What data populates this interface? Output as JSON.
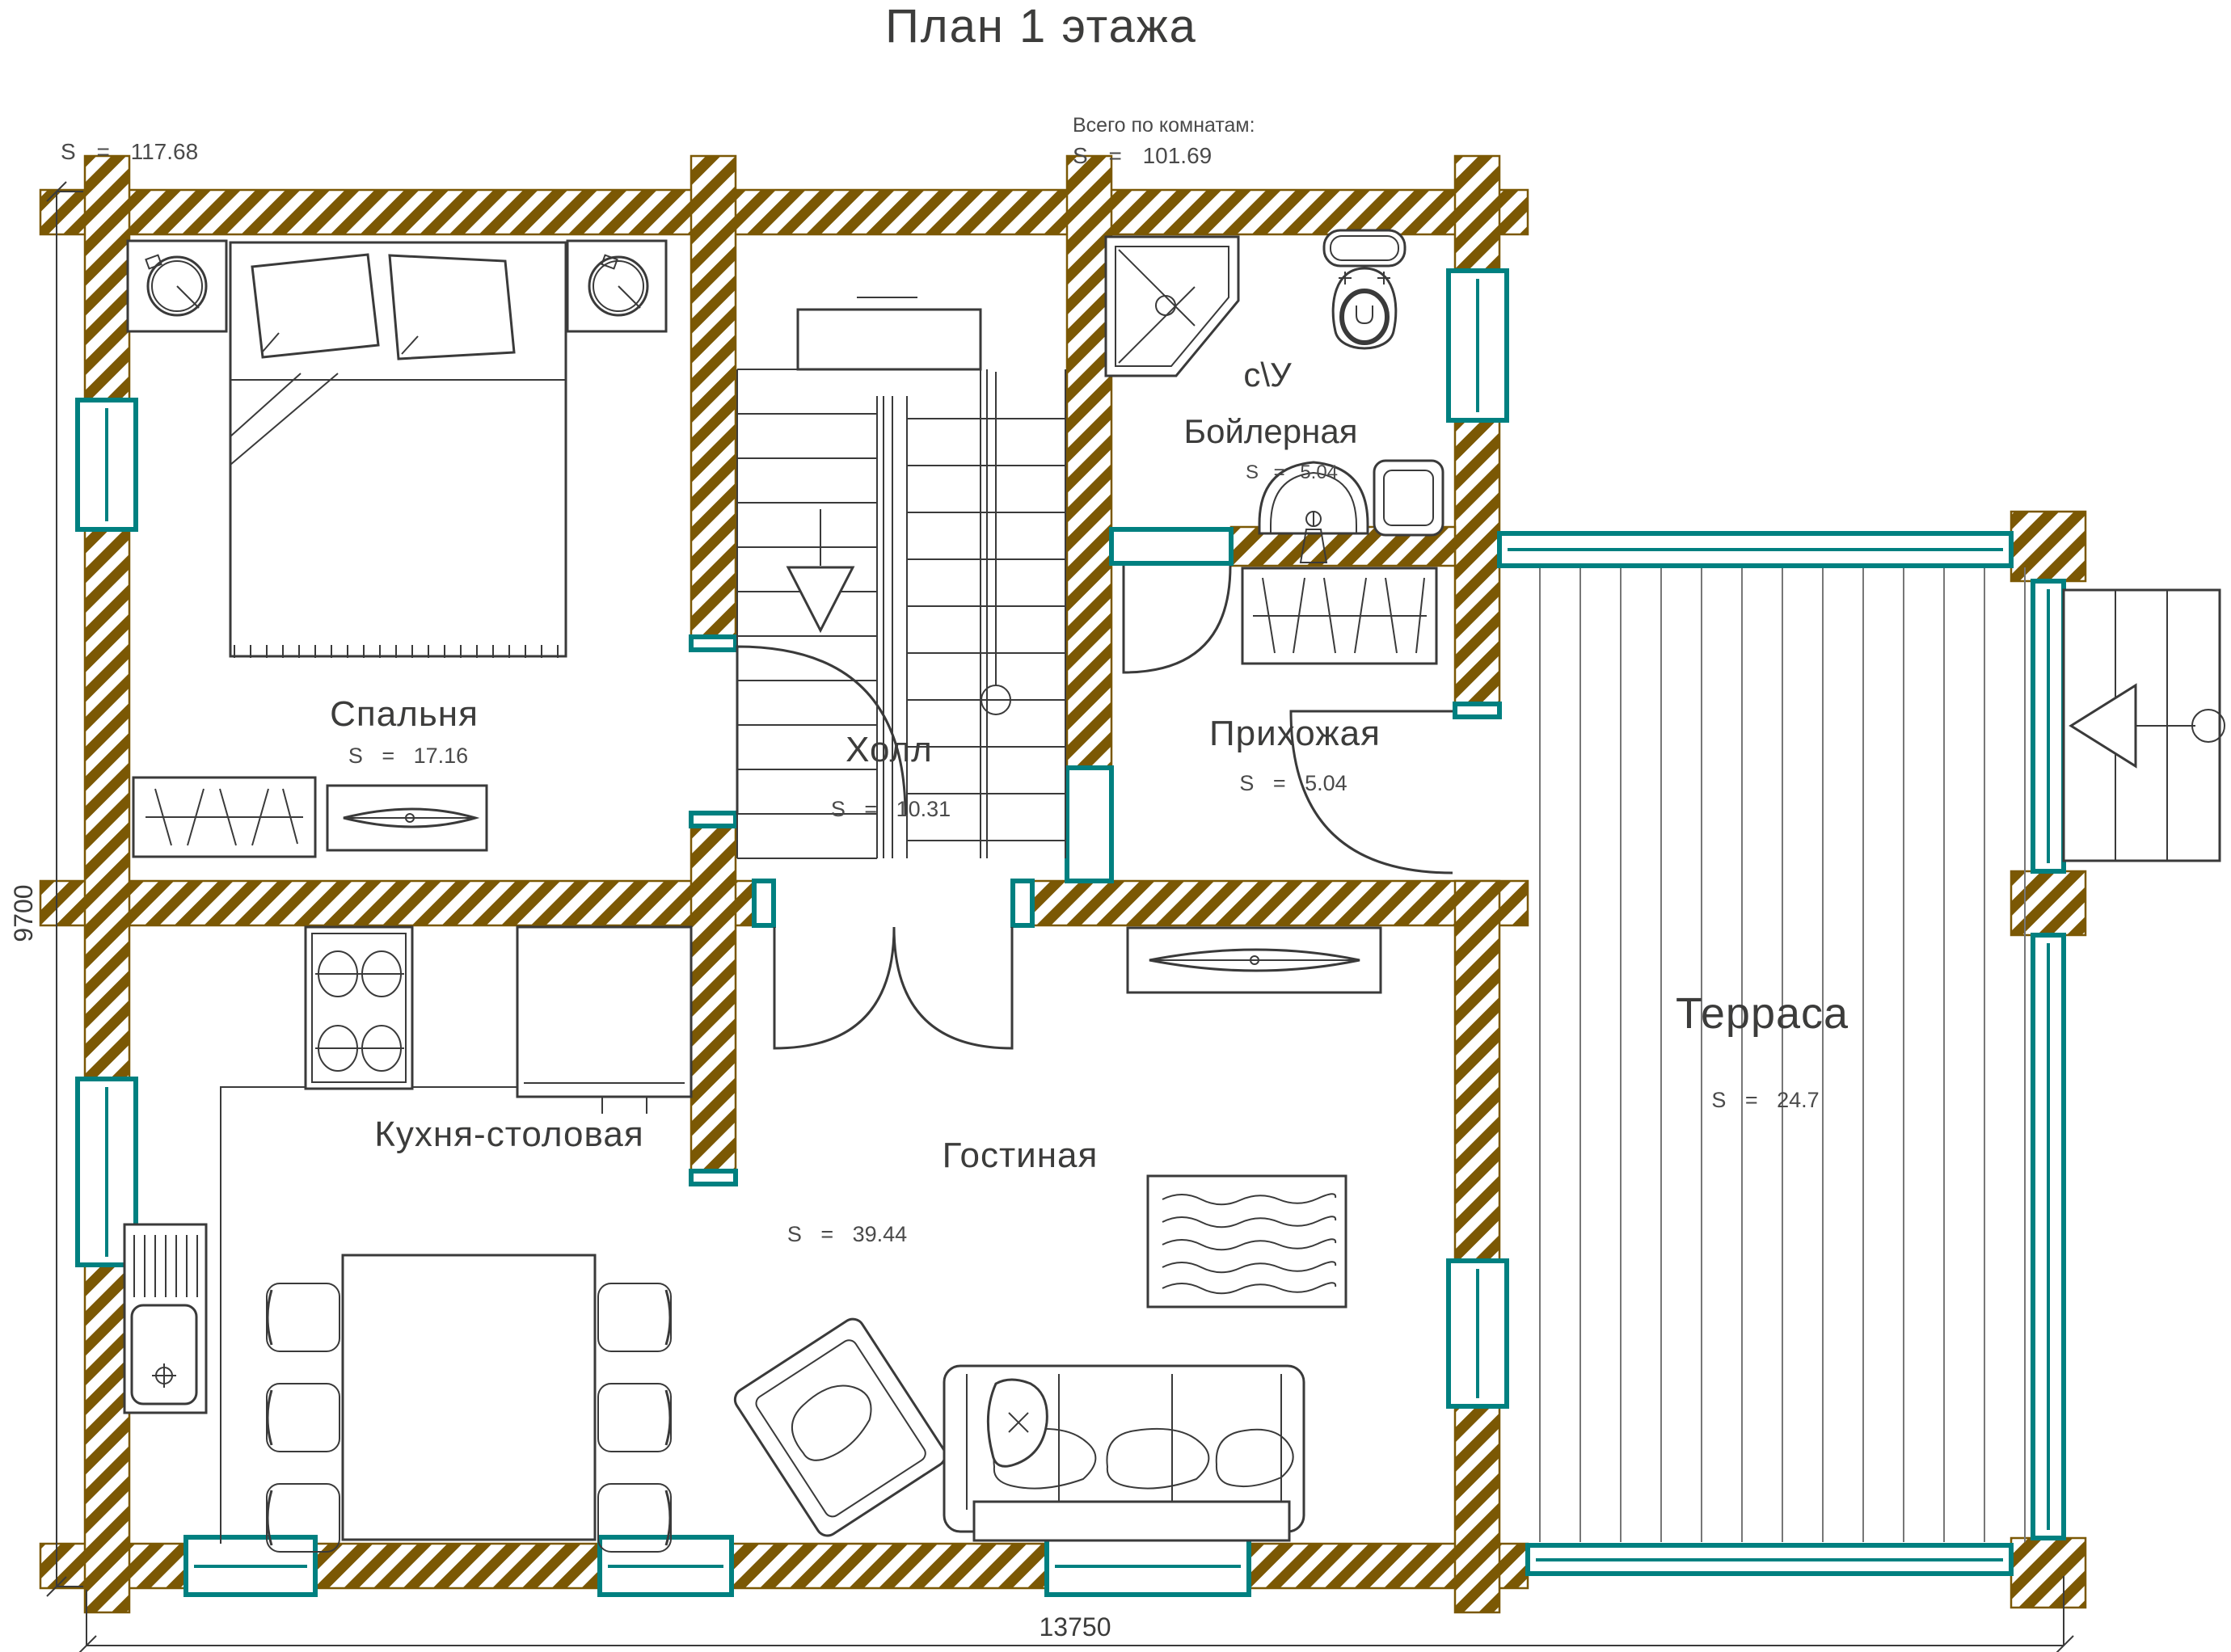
{
  "title": "План 1 этажа",
  "summary": {
    "total_area_label": "S = 117.68",
    "rooms_total_caption": "Всего по комнатам:",
    "rooms_total_value": "S = 101.69"
  },
  "dimensions": {
    "width_label": "13750",
    "height_label": "9700"
  },
  "rooms": {
    "bedroom": {
      "name": "Спальня",
      "area": "S = 17.16"
    },
    "hall": {
      "name": "Холл",
      "area": "S = 10.31"
    },
    "boiler": {
      "name_line1": "с\\У",
      "name_line2": "Бойлерная",
      "area": "S = 5.04"
    },
    "entry": {
      "name": "Прихожая",
      "area": "S = 5.04"
    },
    "kitchen": {
      "name": "Кухня-столовая"
    },
    "living": {
      "name": "Гостиная",
      "area": "S = 39.44"
    },
    "terrace": {
      "name": "Терраса",
      "area": "S = 24.7"
    }
  },
  "colors": {
    "wall_hatch": "#7B5804",
    "window_frame": "#008080",
    "line": "#3A3A3A"
  }
}
